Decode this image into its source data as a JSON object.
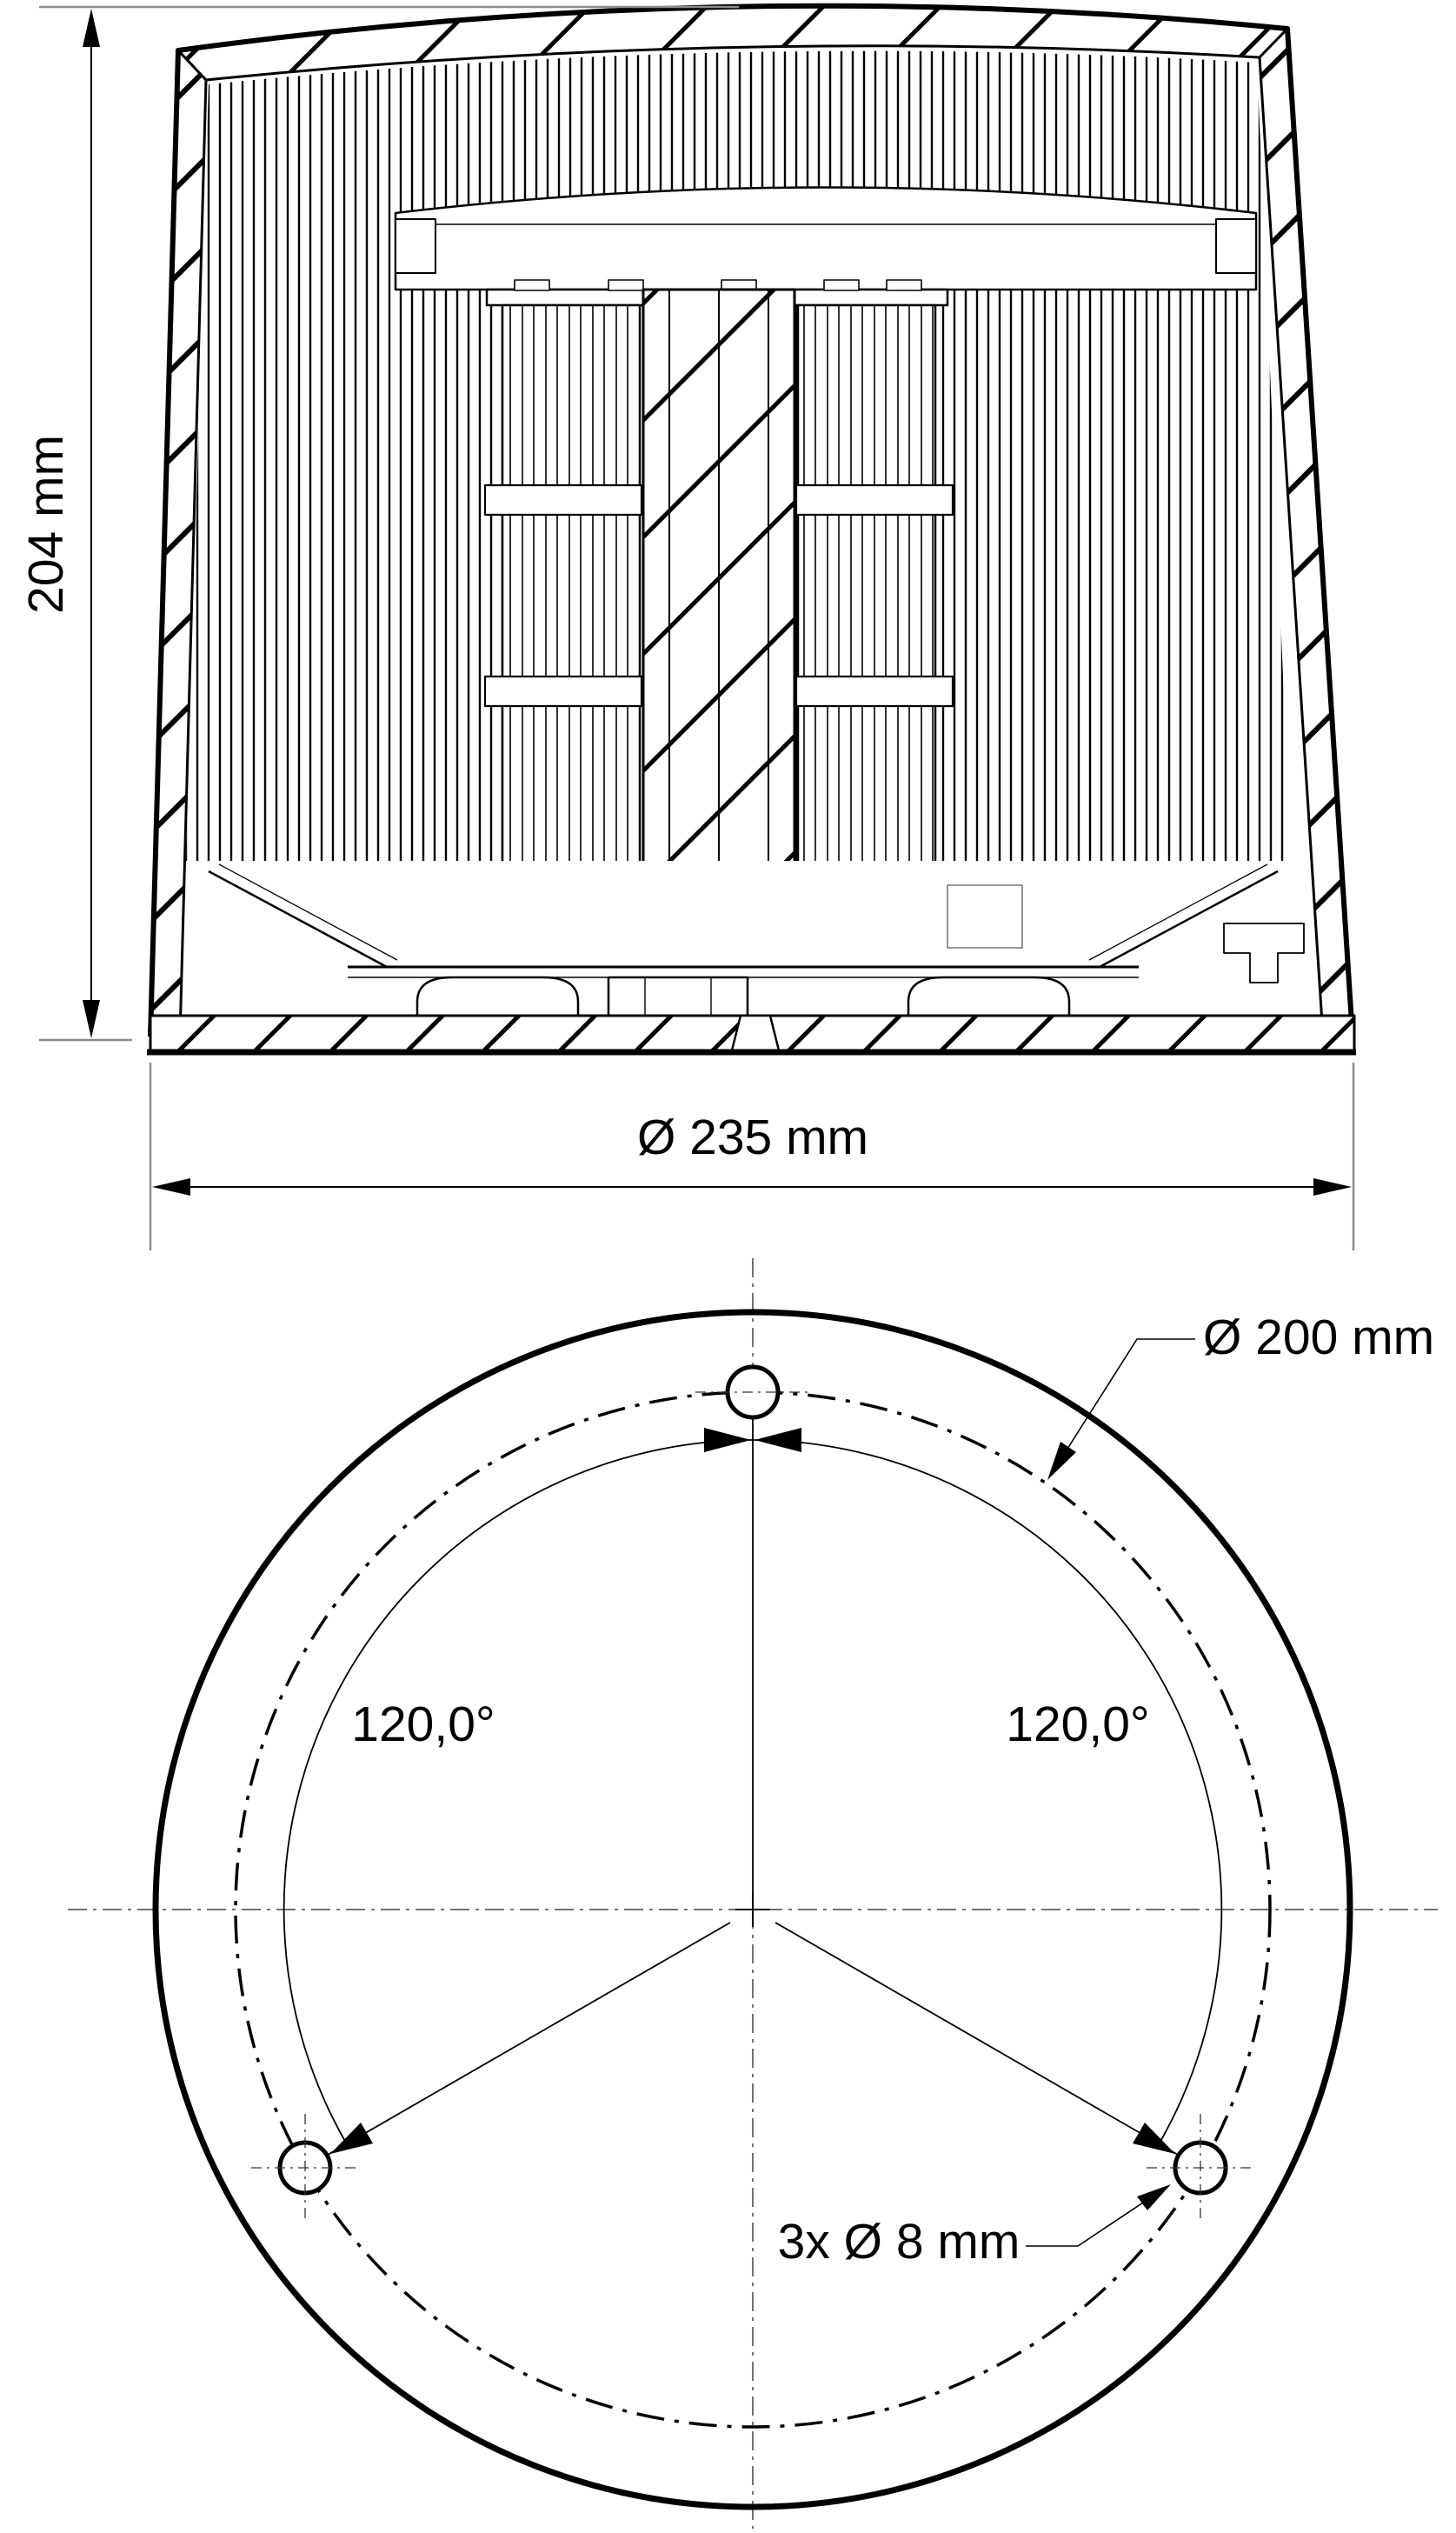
{
  "drawing": {
    "kind": "technical-drawing-2-views",
    "colors": {
      "line": "#000000",
      "extension_line": "#8c8c8c",
      "centerline": "#444444",
      "background": "#ffffff"
    },
    "side_section_view": {
      "name": "beacon cross-section side view",
      "height_label": "204 mm",
      "diameter_label": "Ø 235 mm"
    },
    "bottom_view": {
      "name": "beacon bottom mounting view",
      "bolt_circle_label": "Ø 200 mm",
      "angle_left_label": "120,0°",
      "angle_right_label": "120,0°",
      "holes_label": "3x Ø 8 mm"
    }
  }
}
